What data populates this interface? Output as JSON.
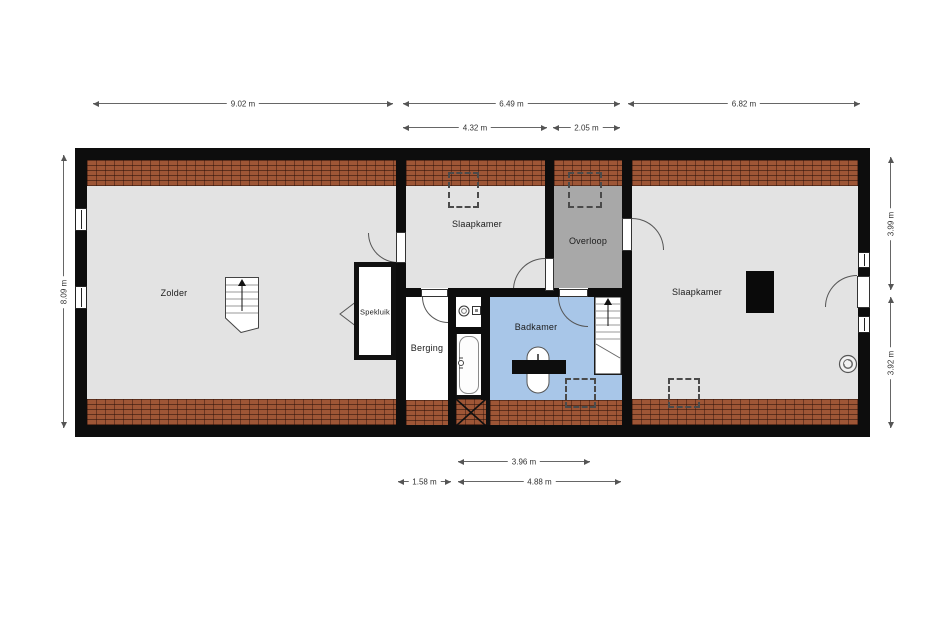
{
  "plan": {
    "rooms": {
      "zolder": "Zolder",
      "slaapkamer_mid": "Slaapkamer",
      "overloop": "Overloop",
      "spekluik": "Spekluik",
      "berging": "Berging",
      "badkamer": "Badkamer",
      "slaapkamer_right": "Slaapkamer"
    },
    "dims": {
      "w_zolder": "9.02 m",
      "w_middle": "6.49 m",
      "w_right": "6.82 m",
      "w_slaapkamer_mid": "4.32 m",
      "w_overloop": "2.05 m",
      "h_left": "8.09 m",
      "h_right_top": "3.99 m",
      "h_right_bottom": "3.92 m",
      "w_badkamer": "3.96 m",
      "w_berging": "1.58 m",
      "w_badkamer_stairs": "4.88 m"
    },
    "colors": {
      "floor": "#e3e3e3",
      "overloop_floor": "#a8a8a8",
      "badkamer_floor": "#a8c6e8",
      "roof_brick": "#9e5636",
      "wall": "#0d0d0d",
      "dimension_line": "#666666"
    },
    "icons": [
      "stairs-icon",
      "door-arc",
      "window-icon",
      "bathtub-icon",
      "washbasin-icon",
      "toilet-icon",
      "ventilation-icon",
      "dormer-outline",
      "void-x-icon",
      "chimney-block"
    ]
  }
}
